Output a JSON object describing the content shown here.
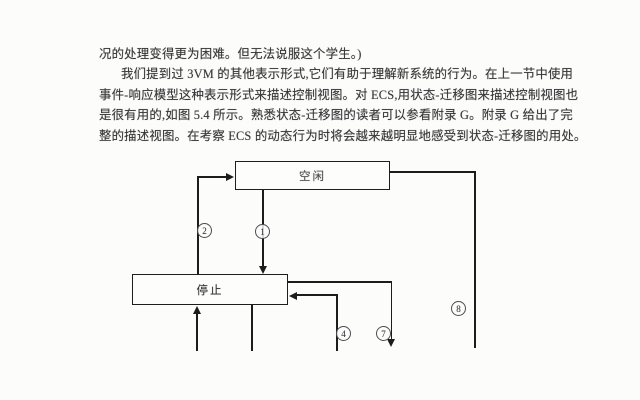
{
  "document": {
    "lines": [
      "况的处理变得更为困难。但无法说服这个学生。)",
      "我们提到过 3VM 的其他表示形式,它们有助于理解新系统的行为。在上一节中使用",
      "事件-响应模型这种表示形式来描述控制视图。对 ECS,用状态-迁移图来描述控制视图也",
      "是很有用的,如图 5.4 所示。熟悉状态-迁移图的读者可以参看附录 G。附录 G 给出了完",
      "整的描述视图。在考察 ECS 的动态行为时将会越来越明显地感受到状态-迁移图的用处。"
    ]
  },
  "figure": {
    "type": "state-transition-diagram",
    "nodes": {
      "top": {
        "label": "空闲"
      },
      "stop": {
        "label": "停止"
      }
    },
    "transition_numbers": {
      "t1": "1",
      "t2": "2",
      "t4": "4",
      "t7": "7",
      "t8": "8"
    }
  },
  "colors": {
    "paper": "#fcfcfb",
    "ink": "#38383a",
    "line": "#1c1c1c"
  }
}
